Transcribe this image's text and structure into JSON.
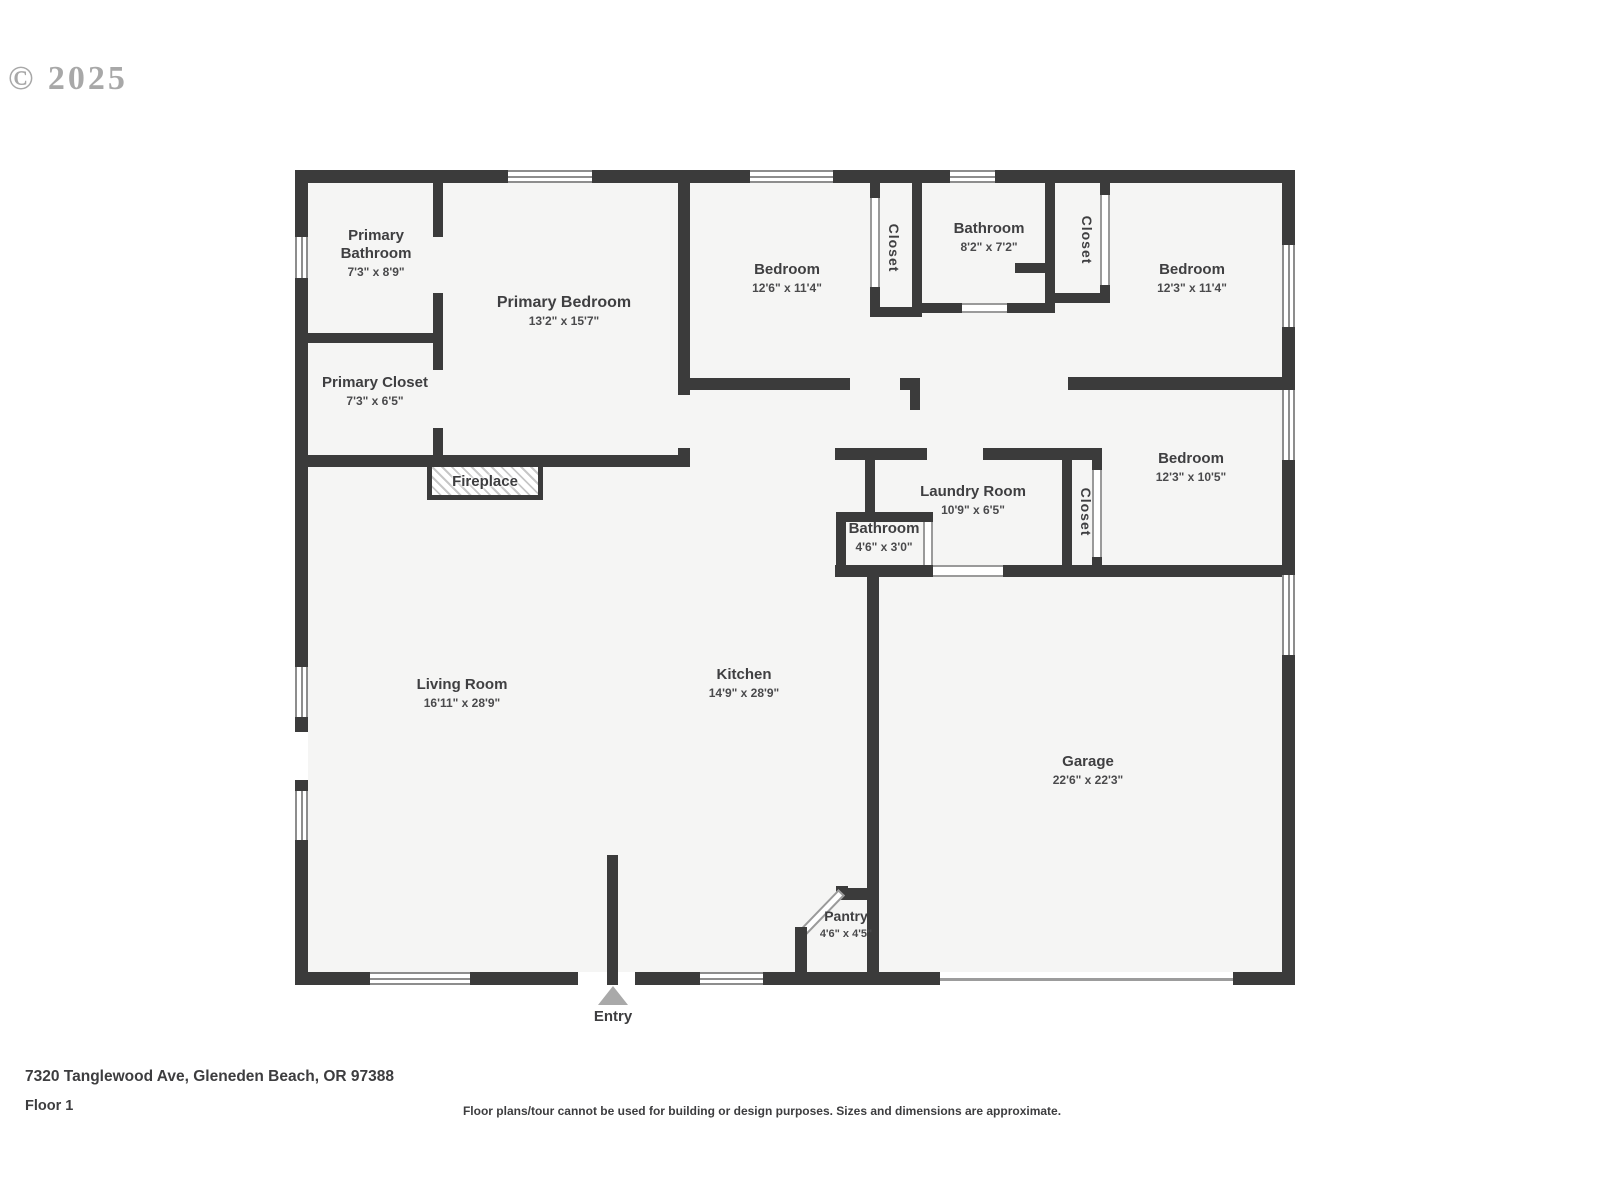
{
  "watermark": "© 2025",
  "plan": {
    "rooms": {
      "primary_bathroom": {
        "name": "Primary Bathroom",
        "dims": "7'3\" x 8'9\""
      },
      "primary_bedroom": {
        "name": "Primary Bedroom",
        "dims": "13'2\" x 15'7\""
      },
      "primary_closet": {
        "name": "Primary Closet",
        "dims": "7'3\" x 6'5\""
      },
      "bedroom_top_middle": {
        "name": "Bedroom",
        "dims": "12'6\" x 11'4\""
      },
      "bathroom_top": {
        "name": "Bathroom",
        "dims": "8'2\" x 7'2\""
      },
      "bedroom_top_right": {
        "name": "Bedroom",
        "dims": "12'3\" x 11'4\""
      },
      "bedroom_mid_right": {
        "name": "Bedroom",
        "dims": "12'3\" x 10'5\""
      },
      "laundry_room": {
        "name": "Laundry Room",
        "dims": "10'9\" x 6'5\""
      },
      "bathroom_small": {
        "name": "Bathroom",
        "dims": "4'6\" x 3'0\""
      },
      "living_room": {
        "name": "Living Room",
        "dims": "16'11\" x 28'9\""
      },
      "kitchen": {
        "name": "Kitchen",
        "dims": "14'9\" x 28'9\""
      },
      "garage": {
        "name": "Garage",
        "dims": "22'6\" x 22'3\""
      },
      "pantry": {
        "name": "Pantry",
        "dims": "4'6\" x 4'5\""
      }
    },
    "features": {
      "fireplace": "Fireplace",
      "closet": "Closet",
      "entry": "Entry"
    }
  },
  "footer": {
    "address": "7320 Tanglewood Ave, Gleneden Beach, OR 97388",
    "floor": "Floor 1",
    "disclaimer": "Floor plans/tour cannot be used for building or design purposes. Sizes and dimensions are approximate."
  },
  "colors": {
    "wall": "#3b3b3b",
    "room_fill": "#f5f5f4",
    "text": "#3f3f41",
    "watermark": "#9a9a9a",
    "entry_marker": "#a9a9a9"
  }
}
